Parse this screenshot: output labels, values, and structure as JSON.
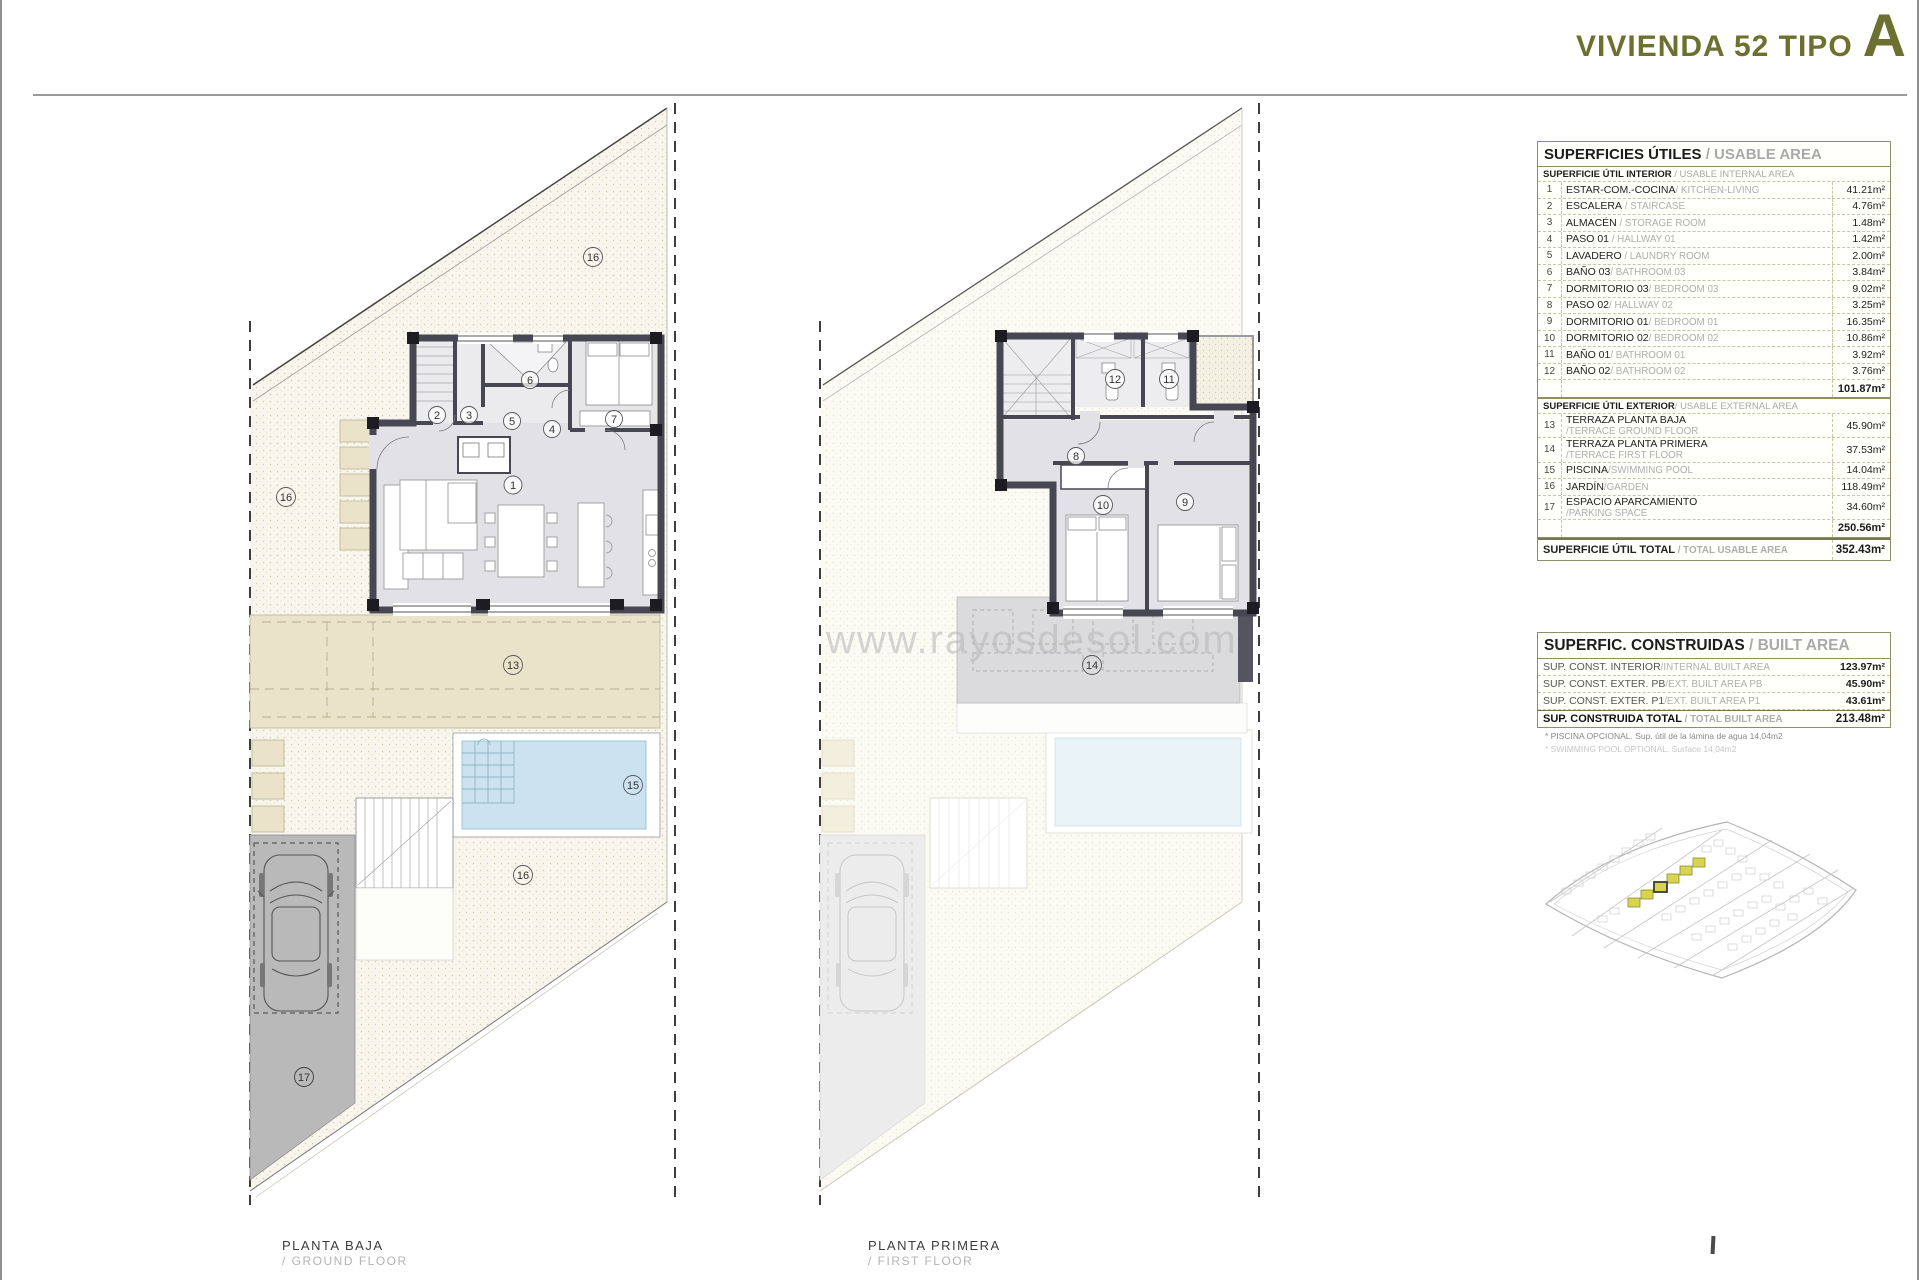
{
  "title": {
    "main": "VIVIENDA 52 TIPO",
    "type_letter": "A"
  },
  "watermark": "www.rayosdesol.com",
  "plan_labels": [
    {
      "es": "PLANTA BAJA",
      "en": "/ GROUND FLOOR"
    },
    {
      "es": "PLANTA PRIMERA",
      "en": "/ FIRST FLOOR"
    }
  ],
  "usable": {
    "title_es": "SUPERFICIES ÚTILES",
    "title_en": " / USABLE AREA",
    "interior_header_es": "SUPERFICIE ÚTIL INTERIOR",
    "interior_header_en": " / USABLE INTERNAL AREA",
    "interior_rows": [
      {
        "num": "1",
        "es": "ESTAR-COM.-COCINA",
        "en": "/ KITCHEN-LIVING",
        "value": "41.21m²"
      },
      {
        "num": "2",
        "es": "ESCALERA",
        "en": " / STAIRCASE",
        "value": "4.76m²"
      },
      {
        "num": "3",
        "es": "ALMACÉN",
        "en": " / STORAGE ROOM",
        "value": "1.48m²"
      },
      {
        "num": "4",
        "es": "PASO 01",
        "en": " / HALLWAY  01",
        "value": "1.42m²"
      },
      {
        "num": "5",
        "es": "LAVADERO",
        "en": " / LAUNDRY ROOM",
        "value": "2.00m²"
      },
      {
        "num": "6",
        "es": "BAÑO 03",
        "en": "/ BATHROOM 03",
        "value": "3.84m²"
      },
      {
        "num": "7",
        "es": "DORMITORIO 03",
        "en": "/ BEDROOM 03",
        "value": "9.02m²"
      },
      {
        "num": "8",
        "es": "PASO 02",
        "en": "/ HALLWAY 02",
        "value": "3.25m²"
      },
      {
        "num": "9",
        "es": "DORMITORIO 01",
        "en": "/ BEDROOM 01",
        "value": "16.35m²"
      },
      {
        "num": "10",
        "es": "DORMITORIO 02",
        "en": "/ BEDROOM 02",
        "value": "10.86m²"
      },
      {
        "num": "11",
        "es": "BAÑO 01",
        "en": "/ BATHROOM 01",
        "value": "3.92m²"
      },
      {
        "num": "12",
        "es": "BAÑO 02",
        "en": "/ BATHROOM 02",
        "value": "3.76m²"
      }
    ],
    "interior_subtotal": "101.87m²",
    "exterior_header_es": "SUPERFICIE ÚTIL EXTERIOR",
    "exterior_header_en": "/ USABLE EXTERNAL AREA",
    "exterior_rows": [
      {
        "num": "13",
        "es": "TERRAZA PLANTA BAJA",
        "en": "/TERRACE GROUND FLOOR",
        "value": "45.90m²"
      },
      {
        "num": "14",
        "es": "TERRAZA PLANTA PRIMERA",
        "en": "/TERRACE FIRST FLOOR",
        "value": "37.53m²"
      },
      {
        "num": "15",
        "es": "PISCINA",
        "en": "/SWIMMING POOL",
        "value": "14.04m²"
      },
      {
        "num": "16",
        "es": "JARDÍN",
        "en": "/GARDEN",
        "value": "118.49m²"
      },
      {
        "num": "17",
        "es": "ESPACIO APARCAMIENTO",
        "en": "/PARKING SPACE",
        "value": "34.60m²"
      }
    ],
    "exterior_subtotal": "250.56m²",
    "total_label_es": "SUPERFICIE ÚTIL TOTAL",
    "total_label_en": " / TOTAL USABLE AREA",
    "total_value": "352.43m²"
  },
  "built": {
    "title_es": "SUPERFIC. CONSTRUIDAS",
    "title_en": " / BUILT AREA",
    "rows": [
      {
        "es": "SUP. CONST. INTERIOR",
        "en": "/INTERNAL BUILT AREA",
        "value": "123.97m²"
      },
      {
        "es": "SUP. CONST. EXTER. PB",
        "en": "/EXT. BUILT AREA PB",
        "value": "45.90m²"
      },
      {
        "es": "SUP. CONST. EXTER. P1",
        "en": "/EXT. BUILT AREA P1",
        "value": "43.61m²"
      }
    ],
    "total_label_es": "SUP. CONSTRUIDA TOTAL",
    "total_label_en": " / TOTAL BUILT AREA",
    "total_value": "213.48m²",
    "footnote_es": "* PISCINA OPCIONAL. Sup. útil de la lámina de agua 14,04m2",
    "footnote_en": "* SWIMMING POOL OPTIONAL. Surface 14,04m2"
  },
  "marks_ground": [
    "1",
    "2",
    "3",
    "4",
    "5",
    "6",
    "7",
    "13",
    "15",
    "16",
    "16",
    "16",
    "17"
  ],
  "marks_first": [
    "8",
    "9",
    "10",
    "11",
    "12",
    "14"
  ],
  "page_marker": "",
  "colors": {
    "accent_olive": "#6d7130",
    "highlight_plot": "#d8d44f",
    "pool_blue": "#cbe3f0",
    "wall": "#474753",
    "terrace_beige": "#eae3c9"
  }
}
